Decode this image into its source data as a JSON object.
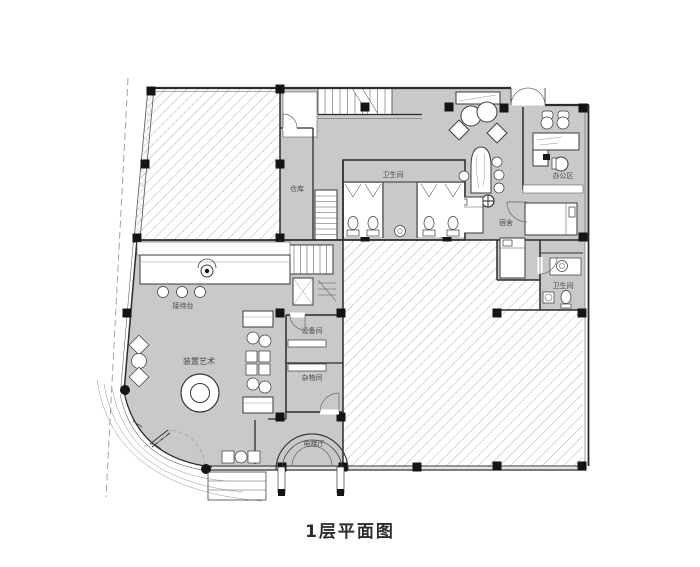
{
  "title": "1层平面图",
  "plan": {
    "rooms": {
      "storage": "仓库",
      "restroom_main": "卫生间",
      "office_area": "办公区",
      "dormitory": "宿舍",
      "restroom_small": "卫生间",
      "reception_desk": "接待台",
      "art_installation": "装置艺术",
      "equipment_room": "设备间",
      "sundry_room": "杂物间",
      "elevator_hall": "电梯厅"
    },
    "colors": {
      "room_fill": "#c9c9c9",
      "hatch_line": "#a9a9a9",
      "wall": "#2b2b2b",
      "column": "#141414",
      "label": "#4a4a4a"
    }
  }
}
